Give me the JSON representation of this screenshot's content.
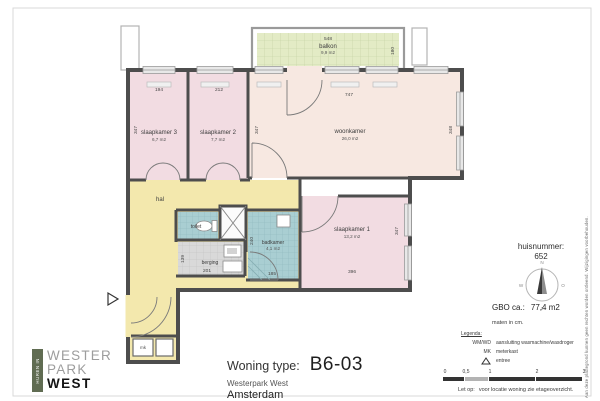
{
  "document": {
    "type_label": "Woning type:",
    "type_value": "B6-03",
    "project": "Westerpark West",
    "city": "Amsterdam"
  },
  "logo": {
    "tagline": "HUREN IN",
    "line1": "WESTER",
    "line2": "PARK",
    "line3": "WEST"
  },
  "plan": {
    "rooms": {
      "balkon": {
        "name": "balkon",
        "area": "9,9 m2"
      },
      "slaapkamer3": {
        "name": "slaapkamer 3",
        "area": "6,7 m2"
      },
      "slaapkamer2": {
        "name": "slaapkamer 2",
        "area": "7,7 m2"
      },
      "woonkamer": {
        "name": "woonkamer",
        "area": "26,0 m2"
      },
      "slaapkamer1": {
        "name": "slaapkamer 1",
        "area": "13,2 m2"
      },
      "badkamer": {
        "name": "badkamer",
        "area": "4,1 m2"
      },
      "hal": {
        "name": "hal"
      },
      "toilet": {
        "name": "toilet"
      },
      "berging": {
        "name": "berging"
      },
      "meterkast": {
        "name": "mk"
      }
    },
    "dims": {
      "balkon_w": "548",
      "balkon_d": "180",
      "sl3_w": "194",
      "sl3_d": "347",
      "sl2_w": "212",
      "woon_w": "747",
      "woon_d_left": "347",
      "woon_d_right": "348",
      "sl1_w": "396",
      "sl1_d": "347",
      "bad_w": "185",
      "bad_d": "240",
      "berg_w": "201",
      "berg_d": "139"
    }
  },
  "info": {
    "huisnummer_label": "huisnummer:",
    "huisnummer_value": "652",
    "compass": {
      "n": "N",
      "e": "O",
      "s": "Z",
      "w": "W"
    },
    "gbo_label": "GBO ca.:",
    "gbo_value": "77,4 m2",
    "units_note": "maten in cm.",
    "legend_title": "Legenda:",
    "legend_wmwd_key": "WM/WD",
    "legend_wmwd_value": "aansluiting wasmachine/wasdroger",
    "legend_mk_key": "MK",
    "legend_mk_value": "meterkast",
    "legend_entree_value": "entree",
    "scale_ticks": [
      "0",
      "0,5",
      "1",
      "2",
      "3"
    ],
    "note_label": "Let op:",
    "note_value": "voor locatie woning zie etageoverzicht.",
    "disclaimer": "Aan deze plattegrond kunnen geen rechten worden ontleend. Wijzigingen voorbehouden."
  },
  "colors": {
    "wall": "#4d4d4d",
    "balkon": "#e3ebc5",
    "slaapkamer": "#f2dce2",
    "woonkamer": "#f7e8e1",
    "hal": "#f3e8ad",
    "sanitair": "#a9ced2",
    "berging": "#d9d9d9",
    "logo_green": "#606c52"
  }
}
